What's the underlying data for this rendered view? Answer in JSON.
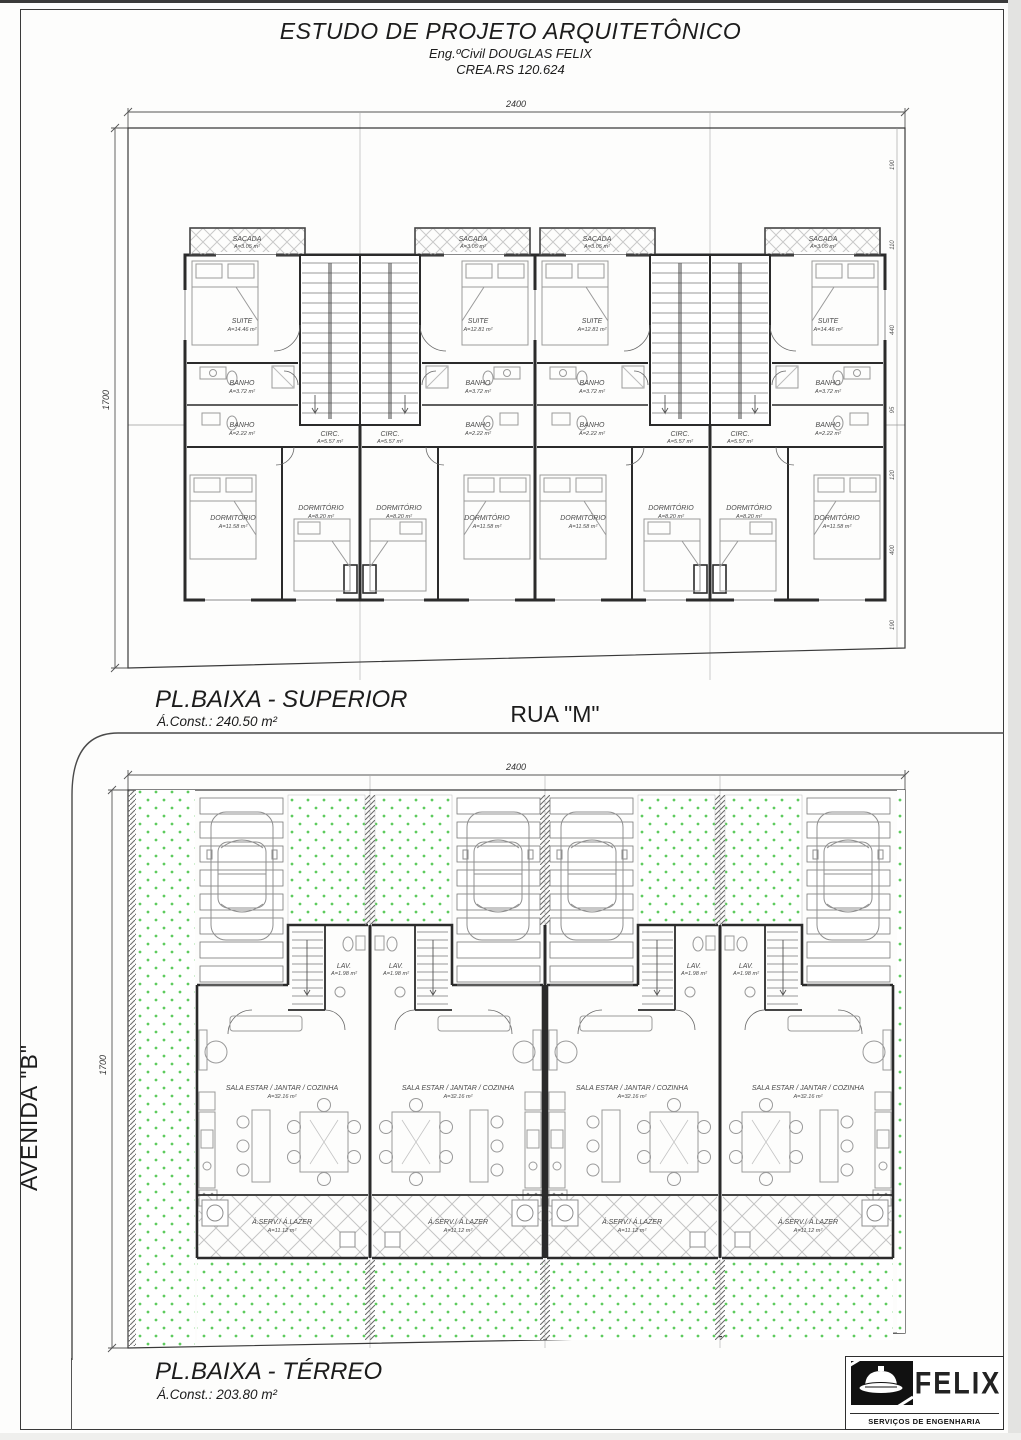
{
  "header": {
    "title": "ESTUDO DE PROJETO ARQUITETÔNICO",
    "engineer": "Eng.ºCivil DOUGLAS FELIX",
    "crea": "CREA.RS 120.624"
  },
  "streets": {
    "horizontal": "RUA \"M\"",
    "vertical": "AVENIDA \"B\""
  },
  "upper_plan": {
    "title": "PL.BAIXA - SUPERIOR",
    "built_area": "Á.Const.: 240.50 m²",
    "dims": {
      "width": "2400",
      "height": "1700"
    },
    "side_dims": [
      "190",
      "110",
      "440",
      "95",
      "120",
      "400",
      "190"
    ],
    "rooms": {
      "sacada": {
        "name": "SACADA",
        "area": "A=3.05 m²"
      },
      "suite": {
        "name": "SUITE",
        "area": "A=14.46 m²"
      },
      "suite_inner": {
        "name": "SUITE",
        "area": "A=12.81 m²"
      },
      "banho": {
        "name": "BANHO",
        "area": "A=3.72 m²"
      },
      "banho_inner": {
        "name": "BANHO",
        "area": "A=2.22 m²"
      },
      "circ": {
        "name": "CIRC.",
        "area": "A=5.57 m²"
      },
      "dorm_big": {
        "name": "DORMITÓRIO",
        "area": "A=11.58 m²"
      },
      "dorm_small": {
        "name": "DORMITÓRIO",
        "area": "A=8.20 m²"
      }
    }
  },
  "ground_plan": {
    "title": "PL.BAIXA - TÉRREO",
    "built_area": "Á.Const.: 203.80 m²",
    "dims": {
      "width": "2400",
      "height": "1700"
    },
    "rooms": {
      "sala": {
        "name": "SALA ESTAR / JANTAR / COZINHA",
        "area": "A=32.16 m²"
      },
      "lav": {
        "name": "LAV.",
        "area": "A=1.98 m²"
      },
      "aserv": {
        "name": "Á.SERV./ Á.LAZER",
        "area": "A=11.12 m²"
      }
    }
  },
  "logo": {
    "brand": "FELIX",
    "tagline": "SERVIÇOS DE ENGENHARIA"
  }
}
